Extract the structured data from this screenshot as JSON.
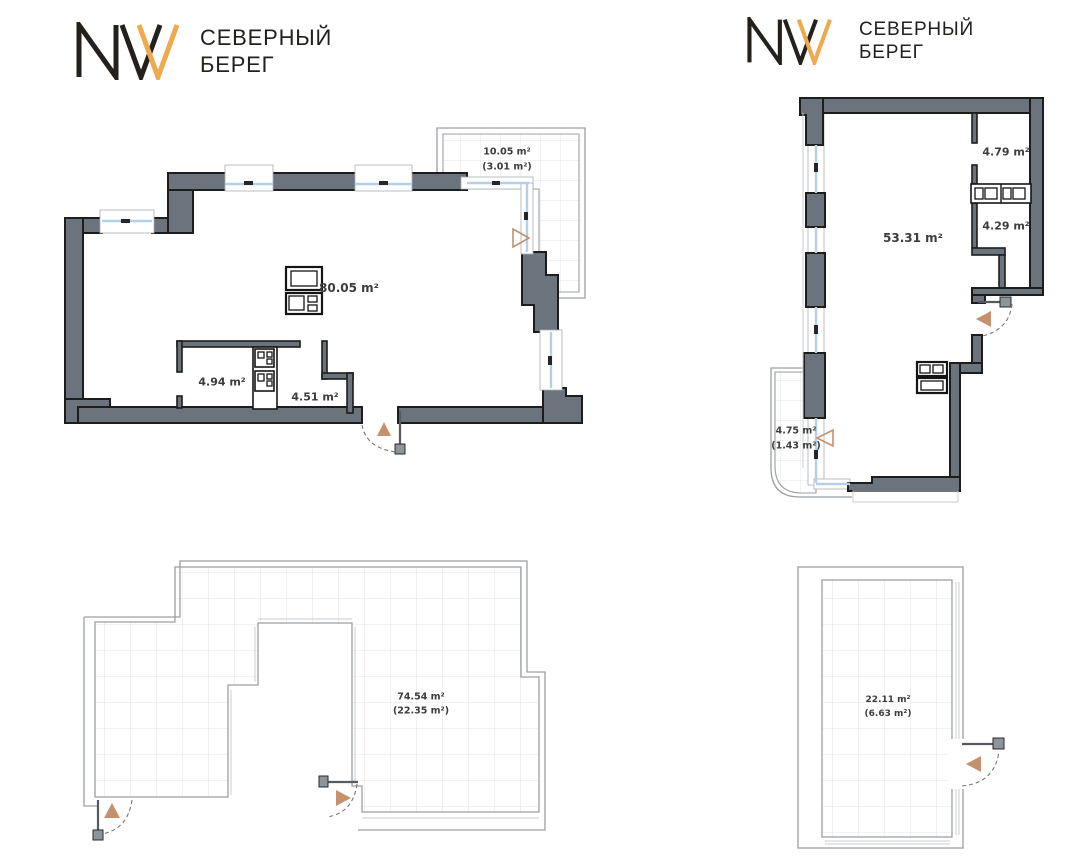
{
  "brand": {
    "monogram": "NVV",
    "line1": "СЕВЕРНЫЙ",
    "line2": "БЕРЕГ"
  },
  "plans": {
    "apartment_a": {
      "living_area": "80.05 m²",
      "bathroom_area": "4.94 m²",
      "hall_area": "4.51 m²",
      "balcony_area": "10.05 m²",
      "balcony_area_reduced": "(3.01 m²)"
    },
    "apartment_b": {
      "living_area": "53.31 m²",
      "room_top_area": "4.79 m²",
      "room_bottom_area": "4.29 m²",
      "balcony_area": "4.75 m²",
      "balcony_area_reduced": "(1.43 m²)"
    },
    "terrace_a": {
      "area": "74.54 m²",
      "area_reduced": "(22.35 m²)"
    },
    "terrace_b": {
      "area": "22.11 m²",
      "area_reduced": "(6.63 m²)"
    }
  },
  "colors": {
    "wall_fill": "#6b737d",
    "wall_outline": "#1d1d1b",
    "window_glass": "#b5cfe9",
    "door_accent": "#c3916e",
    "terrace_line": "#9ba0a5",
    "tile_grid": "#e3e4e6",
    "label_text": "#3c3c3b",
    "brand_accent": "#efa94e",
    "brand_ink": "#24211d"
  }
}
